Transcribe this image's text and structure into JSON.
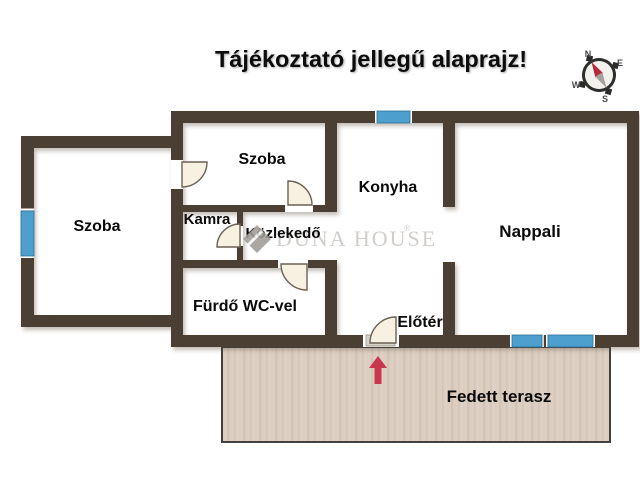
{
  "title": "Tájékoztató jellegű alaprajz!",
  "rooms": {
    "szoba_left": {
      "label": "Szoba"
    },
    "szoba_top": {
      "label": "Szoba"
    },
    "konyha": {
      "label": "Konyha"
    },
    "nappali": {
      "label": "Nappali"
    },
    "kamra": {
      "label": "Kamra"
    },
    "kozlekedo": {
      "label": "Közlekedő"
    },
    "furdo_wc": {
      "label": "Fürdő WC-vel"
    },
    "eloter": {
      "label": "Előtér"
    },
    "fedett_terasz": {
      "label": "Fedett terasz"
    }
  },
  "watermark": {
    "brand": "DUNA HOUSE",
    "registered": "®"
  },
  "compass": {
    "north": "N",
    "east": "E",
    "south": "S",
    "west": "W"
  },
  "colors": {
    "wall": "#4b3e33",
    "window_blue": "#4d9fce",
    "terrace_fill": "#dccfc2",
    "entrance_arrow_red": "#c8374f",
    "watermark_gray": "#c9c6c2",
    "label_black": "#0a0a0a"
  }
}
